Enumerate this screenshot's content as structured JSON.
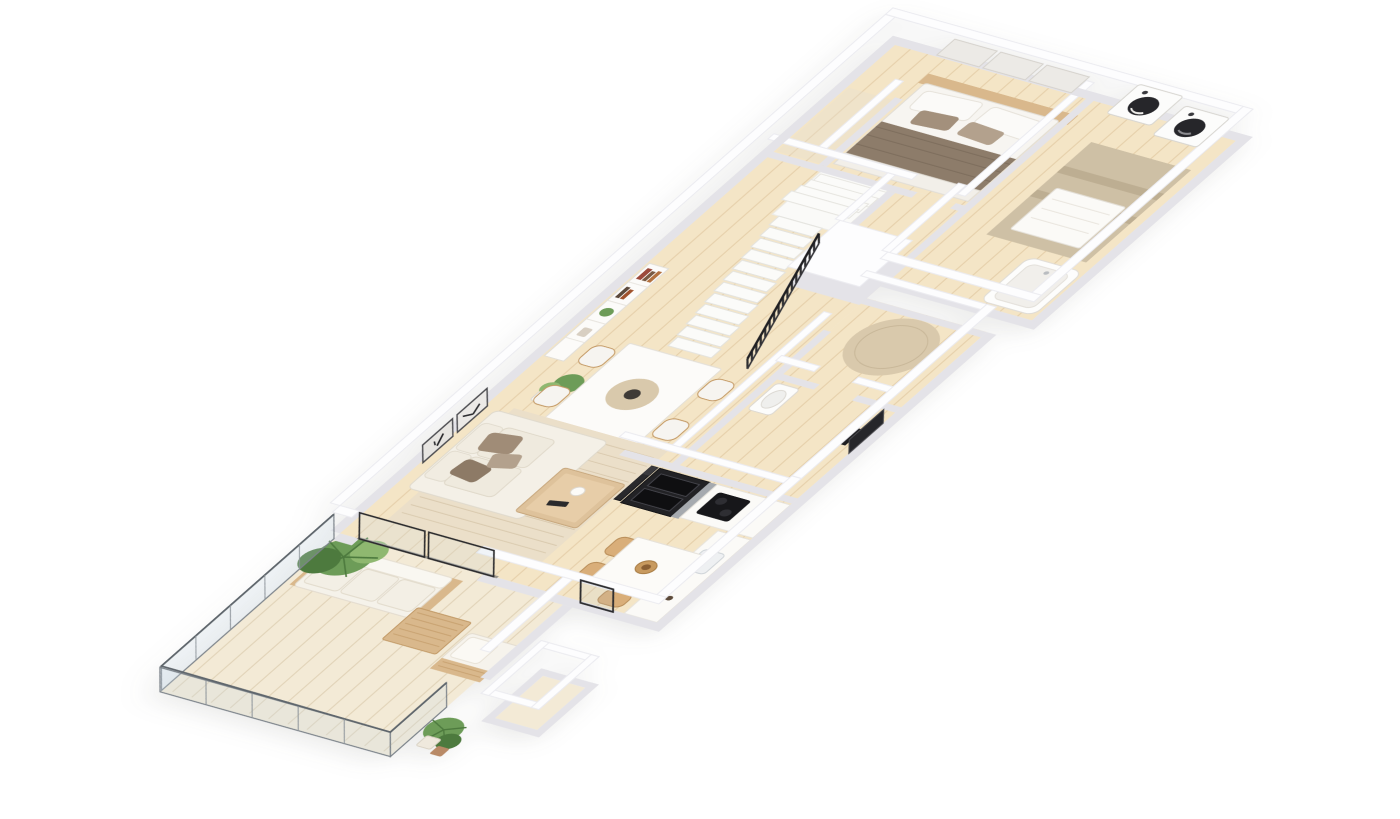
{
  "page": {
    "background": "#ffffff"
  },
  "scene": {
    "type": "isometric-3d-floor-plan-render",
    "style": "minimalist beige and white apartment visualization on plain white background",
    "rooms": [
      {
        "name": "bedroom",
        "contents": [
          "double-bed",
          "taupe-blanket",
          "white-pillows",
          "wood-headboard",
          "wall-mounted-panels",
          "closet-nook"
        ]
      },
      {
        "name": "laundry-bathroom-wing",
        "contents": [
          "washing-machine",
          "dryer",
          "beige-area-rug",
          "white-bench",
          "bathtub"
        ]
      },
      {
        "name": "hallway-stairs",
        "contents": [
          "staircase",
          "black-slat-railing",
          "stairwell-box",
          "round-beige-rug"
        ]
      },
      {
        "name": "wc",
        "contents": [
          "washbasin",
          "dark-framed-mirror",
          "dark-vanity"
        ]
      },
      {
        "name": "living-dining",
        "contents": [
          "white-bookshelf",
          "books",
          "two-wall-art-frames",
          "cream-sofa",
          "taupe-throw-pillows",
          "textured-area-rug",
          "wood-coffee-table",
          "white-dining-table",
          "four-dining-chairs",
          "round-placemat-with-bowl",
          "potted-plants",
          "sliding-glass-door"
        ]
      },
      {
        "name": "kitchen",
        "contents": [
          "black-oven-column",
          "black-low-unit",
          "steel-side-panel",
          "black-cooktop",
          "white-counter",
          "sink",
          "jars",
          "illegible-counter-print",
          "kitchen-table",
          "wood-chairs",
          "fruit-bowl",
          "counter-plant"
        ]
      },
      {
        "name": "balcony",
        "contents": [
          "glass-balustrade",
          "outdoor-white-sofa",
          "slatted-wood-coffee-table",
          "outdoor-armchair",
          "large-palm-plant",
          "two-planter-pots",
          "exterior-white-box",
          "dark-door-frame"
        ]
      }
    ],
    "notes": "no legible text anywhere; tiny illegible grey print on kitchen counter edge"
  },
  "palette": {
    "white": "#ffffff",
    "wallTop": "#fdfdfe",
    "wallSide": "#e4e3e8",
    "wallStroke": "#ebebf0",
    "floor": "#f4e5c6",
    "floorLine": "rgba(193,156,100,0.28)",
    "balconyFloor": "#f3ead6",
    "balconyLine": "rgba(185,160,115,0.30)",
    "rugLiving": "#ebdfc9",
    "rugStreak": "rgba(176,148,108,0.35)",
    "rugRound": "#d9c9ac",
    "rugWing": "#cec0a5",
    "wood": "#d9b88c",
    "woodDark": "#c29a67",
    "cream": "#f4f0e7",
    "creamShade": "#e6dfd2",
    "taupe": "#a3907c",
    "blanket": "#8d7c6a",
    "black": "#222225",
    "steel": "#a6aaaf",
    "mirror": "#26262a",
    "green": "#6d9c58",
    "greenDark": "#4d7a3e",
    "greenLight": "#8fb870",
    "glass": "rgba(205,220,230,0.25)",
    "glassFrame": "#7c838a",
    "potTerracotta": "#b98a66"
  }
}
